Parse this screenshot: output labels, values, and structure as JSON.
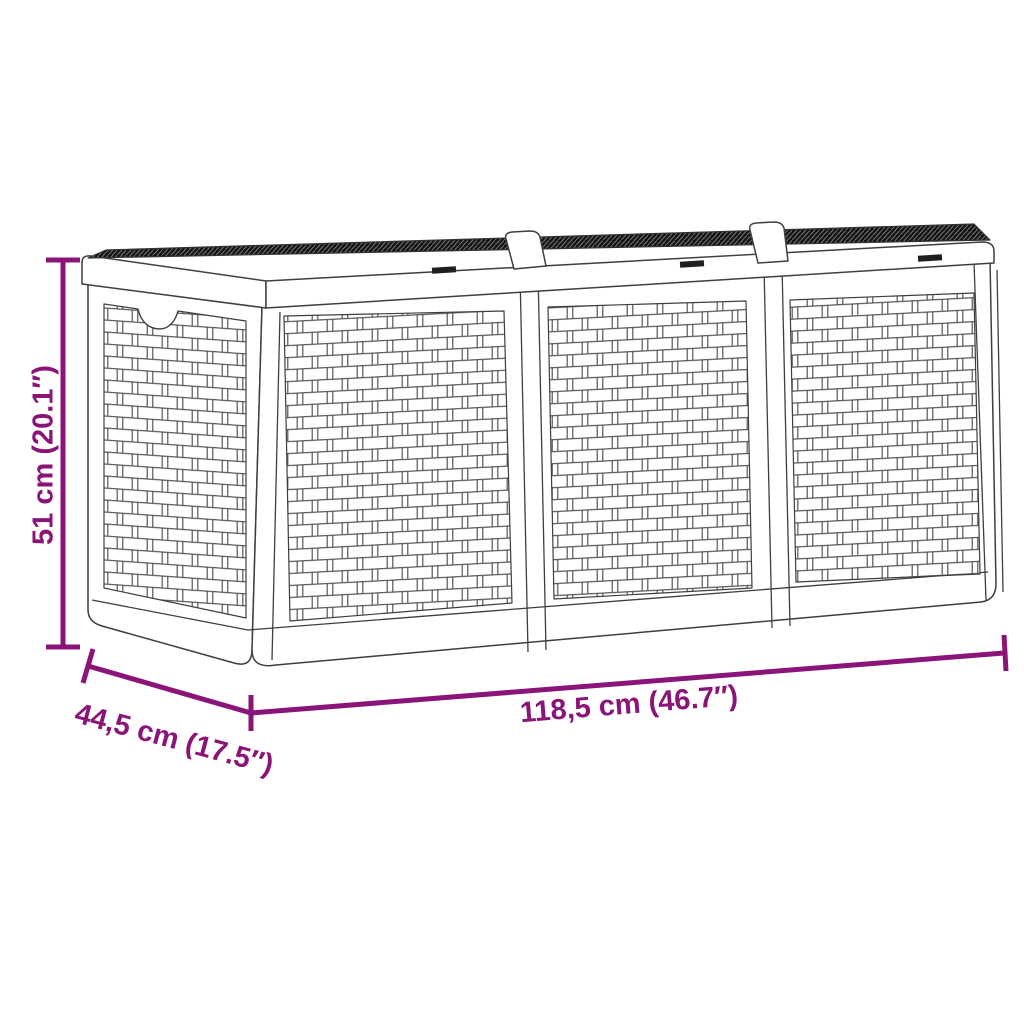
{
  "colors": {
    "accent": "#8B1478",
    "outline": "#3F3F3F",
    "lid_texture": "#151515",
    "background": "#FFFFFF"
  },
  "diagram": {
    "subject": "poly rattan three-section garden storage box line drawing",
    "dimensions": {
      "height": {
        "label": "51 cm (20.1″)"
      },
      "depth": {
        "label": "44,5 cm (17.5″)"
      },
      "width": {
        "label": "118,5 cm (46.7″)"
      }
    }
  }
}
